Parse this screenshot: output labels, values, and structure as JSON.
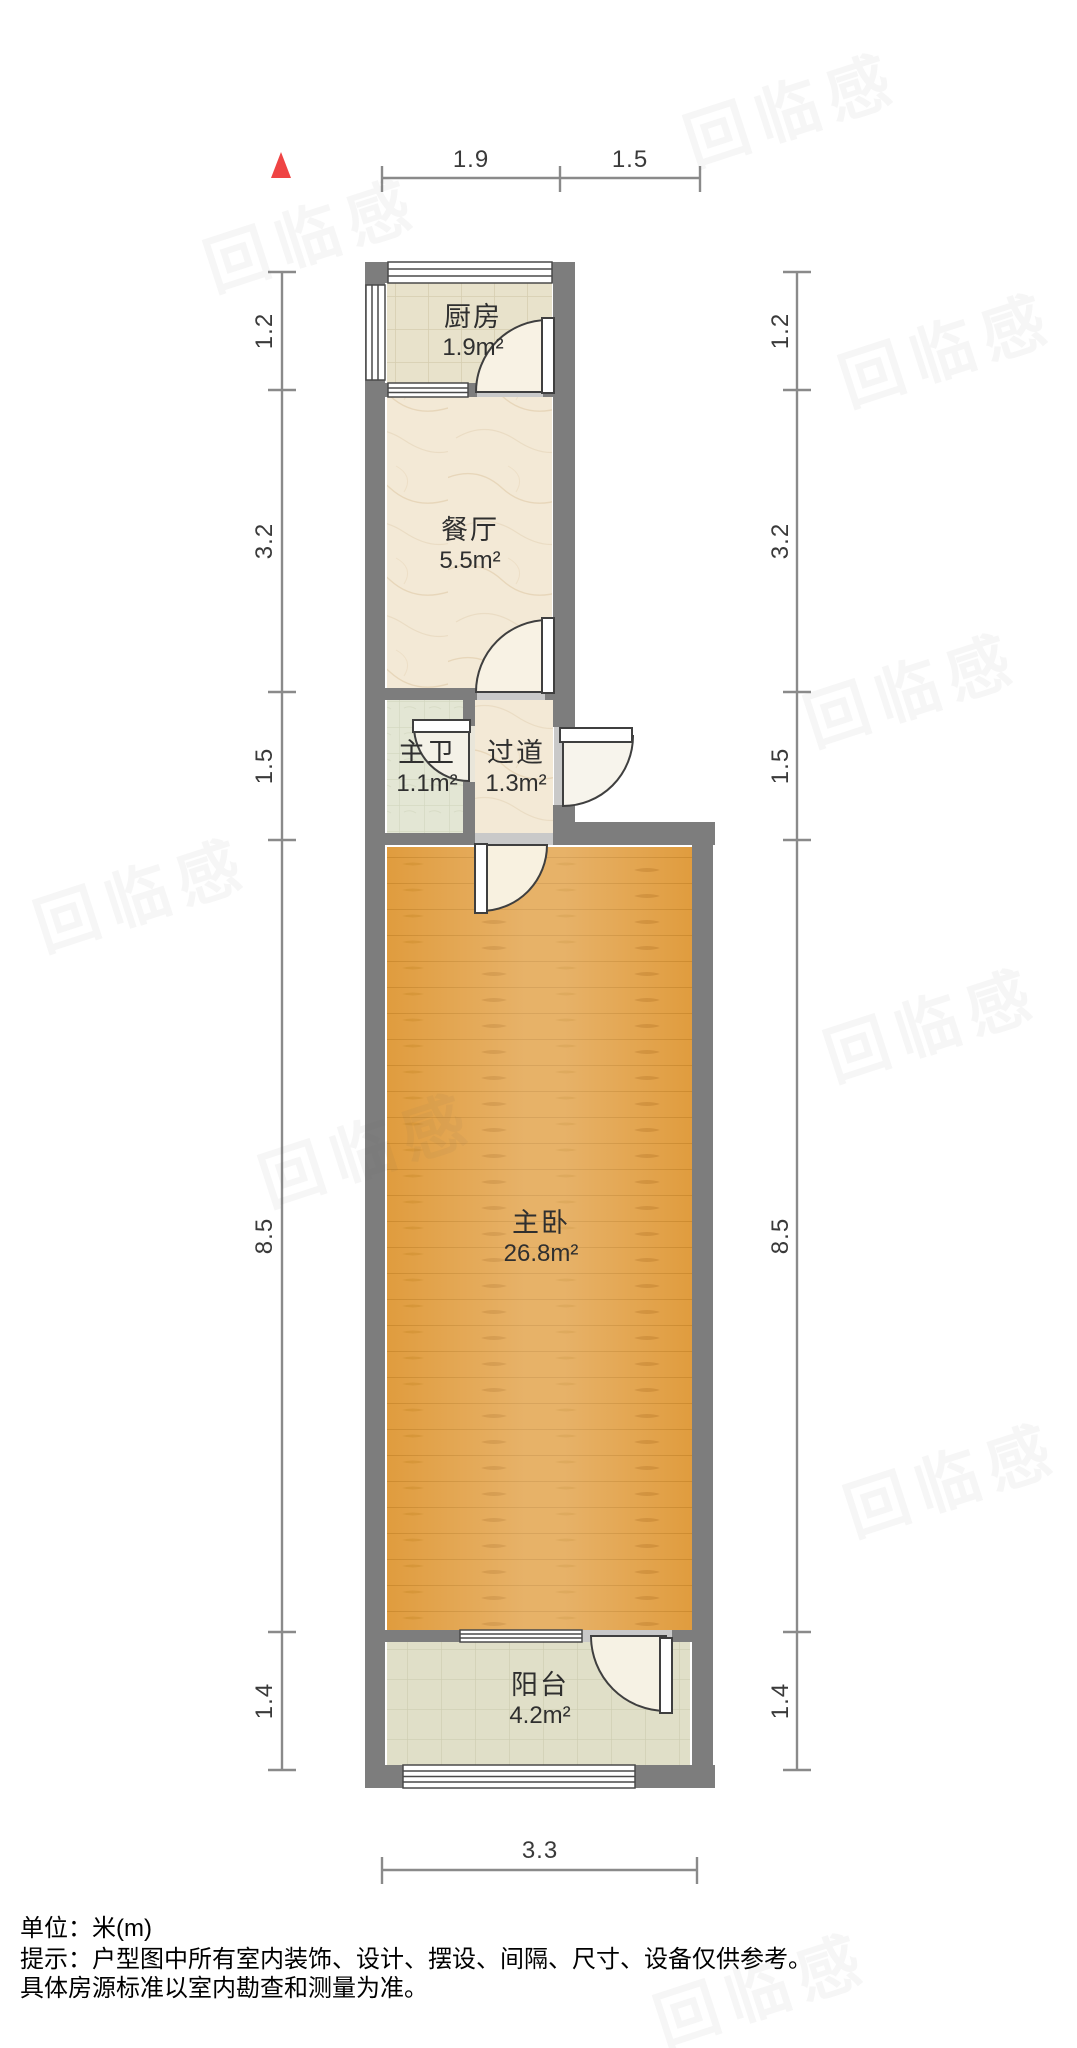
{
  "north_indicator": {
    "icon": "north-triangle",
    "color": "#ef4444"
  },
  "dimensions": {
    "top": [
      "1.9",
      "1.5"
    ],
    "bottom": [
      "3.3"
    ],
    "left": [
      "1.2",
      "3.2",
      "1.5",
      "8.5",
      "1.4"
    ],
    "right": [
      "1.2",
      "3.2",
      "1.5",
      "8.5",
      "1.4"
    ]
  },
  "rooms": [
    {
      "name": "厨房",
      "area": "1.9m²"
    },
    {
      "name": "餐厅",
      "area": "5.5m²"
    },
    {
      "name": "主卫",
      "area": "1.1m²"
    },
    {
      "name": "过道",
      "area": "1.3m²"
    },
    {
      "name": "主卧",
      "area": "26.8m²"
    },
    {
      "name": "阳台",
      "area": "4.2m²"
    }
  ],
  "footer": {
    "unit": "单位：米(m)",
    "note1": "提示：户型图中所有室内装饰、设计、摆设、间隔、尺寸、设备仅供参考。",
    "note2": "具体房源标准以室内勘查和测量为准。"
  },
  "watermark": {
    "text": "回临感"
  },
  "colors": {
    "wall": "#7d7d7d",
    "door_sill": "#c9c9c9",
    "wood_floor": "#e09c3e",
    "tile_kitchen": "#e8e2cb",
    "tile_bath": "#e3e6d4",
    "tile_balcony": "#e0dfc8",
    "marble_floor": "#f3e9d6",
    "door_swing_fill": "#f8f2e4",
    "dimension_line": "#8a8a8a",
    "north_arrow": "#ef4444"
  }
}
